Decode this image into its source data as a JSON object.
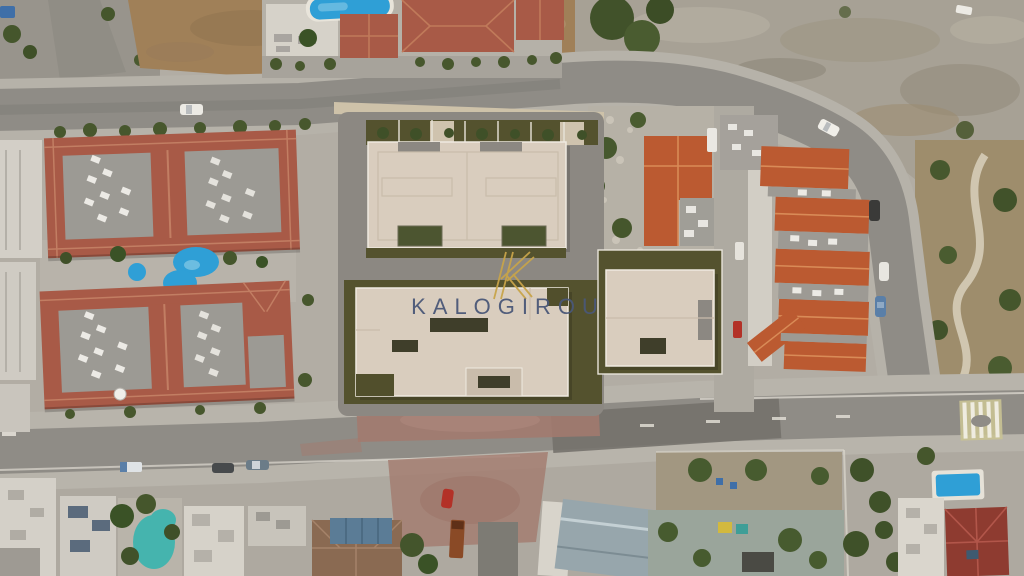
{
  "watermark": {
    "logo_letter": "K",
    "brand": "KALOGIROU",
    "brand_color": "#4a5878",
    "logo_gold": "#c8a44a"
  },
  "palette": {
    "pool_blue": "#2f9fd6",
    "pool_teal": "#45b4ae",
    "roof_terracotta": "#a85a47",
    "roof_orange": "#bb5a31",
    "roof_dark_red": "#8e3b30",
    "render_beige": "#d9cdbe",
    "render_green": "#54522e",
    "road_gray": "#8f8c86",
    "dirt_red": "#a37a6e",
    "dirt_brown": "#a08058",
    "rock_gray": "#a7a195"
  }
}
